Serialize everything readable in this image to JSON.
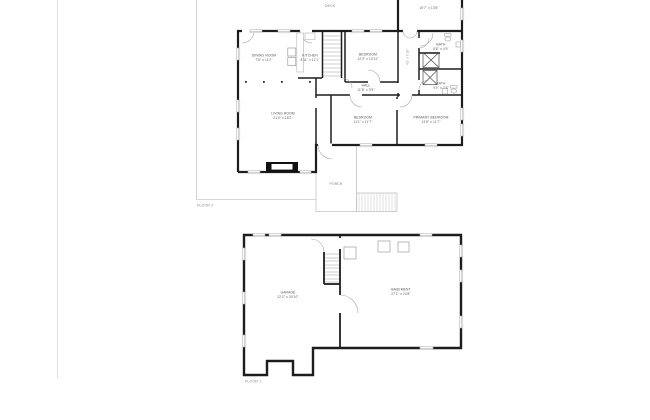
{
  "document": {
    "type": "two-story residential floor plan",
    "background": "#ffffff"
  },
  "colors": {
    "wall": "#1d1d1d",
    "thin_line": "#c4c4c4",
    "fixture_line": "#9a9a9a",
    "label_text": "#4f4f4f",
    "muted_text": "#8a8a8a"
  },
  "floor2": {
    "title": "FLOOR 2",
    "deck_label": "DECK",
    "porch_label": "PORCH",
    "rooms": {
      "dining": {
        "name": "DINING ROOM",
        "dims": "7'8\" x 11'2\""
      },
      "kitchen": {
        "name": "KITCHEN",
        "dims": "8'11\" x 11'1\""
      },
      "living": {
        "name": "LIVING ROOM",
        "dims": "21'4\" x 18'2\""
      },
      "bedroom_top": {
        "name": "BEDROOM",
        "dims": "12'3\" x 10'11\""
      },
      "hall": {
        "name": "HALL",
        "dims": "11'8\" x 3'9\""
      },
      "bath_top": {
        "name": "BATH",
        "dims": "8'8\" x 4'9\""
      },
      "bath_mid": {
        "name": "BATH",
        "dims": "9'0\" x 7'6\""
      },
      "bedroom_bottom": {
        "name": "BEDROOM",
        "dims": "11'1\" x 11'7\""
      },
      "primary": {
        "name": "PRIMARY BEDROOM",
        "dims": "13'8\" x 11'7\""
      },
      "upper_partial": {
        "dims": "15'7\" x 13'5\""
      },
      "closet": {
        "dims": "4'2\" x 7'10\""
      }
    }
  },
  "floor1": {
    "title": "FLOOR 1",
    "rooms": {
      "garage": {
        "name": "GARAGE",
        "dims": "22'2\" x 30'10\""
      },
      "basement": {
        "name": "BASEMENT",
        "dims": "27'1\" x 24'8\""
      }
    }
  }
}
